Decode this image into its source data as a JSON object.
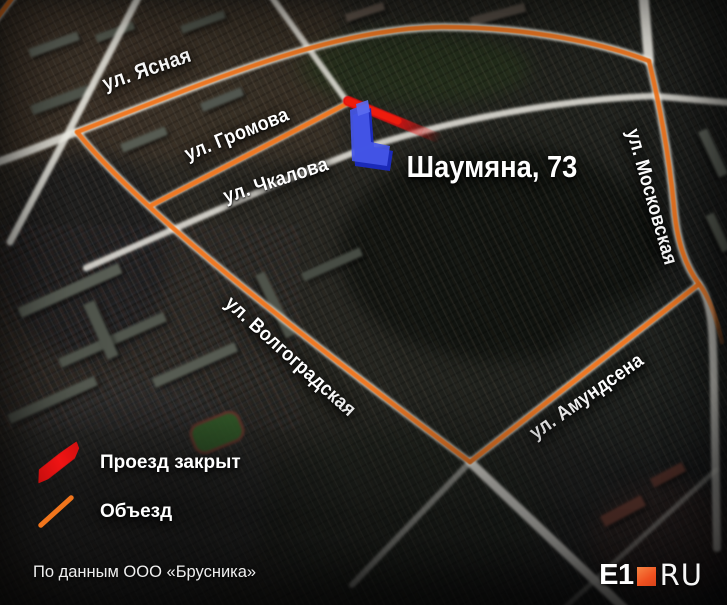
{
  "map": {
    "address_label": "Шаумяна, 73",
    "streets": [
      {
        "id": "yasnaya",
        "label": "ул. Ясная"
      },
      {
        "id": "gromova",
        "label": "ул. Громова"
      },
      {
        "id": "chkalova",
        "label": "ул. Чкалова"
      },
      {
        "id": "volgogradskaya",
        "label": "ул. Волгоградская"
      },
      {
        "id": "moskovskaya",
        "label": "ул. Московская"
      },
      {
        "id": "amundsena",
        "label": "ул. Амундсена"
      }
    ],
    "colors": {
      "detour_route": "#f1751c",
      "closed_road": "#e41111",
      "highlighted_building": "#4557e8",
      "road": "#f6f4ec"
    }
  },
  "legend": {
    "items": [
      {
        "label": "Проезд закрыт",
        "swatch": "closed-road-marker",
        "color": "#e41111"
      },
      {
        "label": "Объезд",
        "swatch": "detour-line",
        "color": "#f1751c"
      }
    ]
  },
  "footer": {
    "source_note": "По данным ООО «Брусника»"
  },
  "logo": {
    "part1": "E1",
    "part2": "RU",
    "square_color": "#ef501f"
  }
}
